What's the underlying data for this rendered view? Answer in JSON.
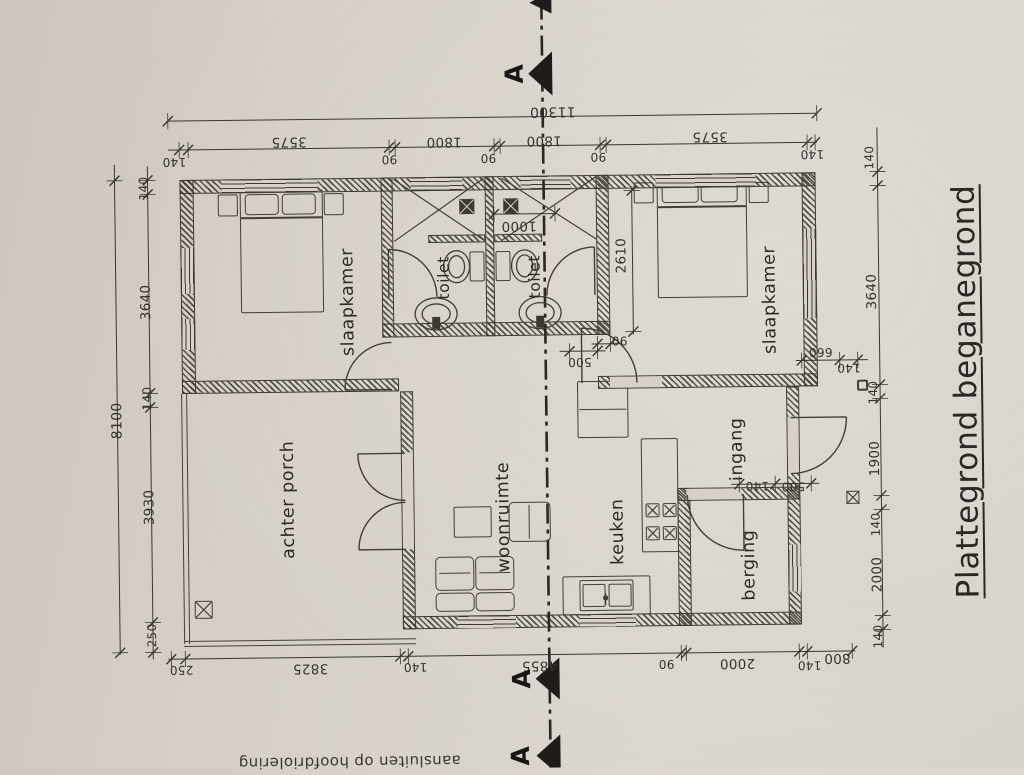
{
  "title": "Plattegrond beganegrond",
  "section": {
    "letter": "A"
  },
  "note_bottom": "aansluiten op hoofdriolering",
  "rooms": {
    "slaapkamer_left": "slaapkamer",
    "slaapkamer_right": "slaapkamer",
    "toilet_left": "toilet",
    "toilet_right": "toilet",
    "porch": "achter porch",
    "living": "woonruimte",
    "kitchen": "keuken",
    "storage": "berging",
    "entrance": "ingang"
  },
  "dims": {
    "total_width": "11300",
    "total_depth": "8100",
    "top": [
      "140",
      "3575",
      "90",
      "1800",
      "90",
      "1800",
      "90",
      "3575",
      "140"
    ],
    "left": [
      "140",
      "3640",
      "140",
      "3930",
      "250"
    ],
    "right": [
      "140",
      "3640",
      "140",
      "1900",
      "140",
      "2000",
      "140"
    ],
    "bottom": [
      "250",
      "3825",
      "140",
      "4855",
      "90",
      "2000",
      "140",
      "800"
    ],
    "shower_width": "1000",
    "bedroom2_depth": "2610",
    "wall_90": "90",
    "door_offset_500": "500",
    "nook_660": "660",
    "nook_140": "140",
    "entry_140": "140",
    "entry_500": "500"
  },
  "colors": {
    "paper": "#d8d2ca",
    "ink": "#3e3933",
    "marker": "#1e1b19"
  }
}
